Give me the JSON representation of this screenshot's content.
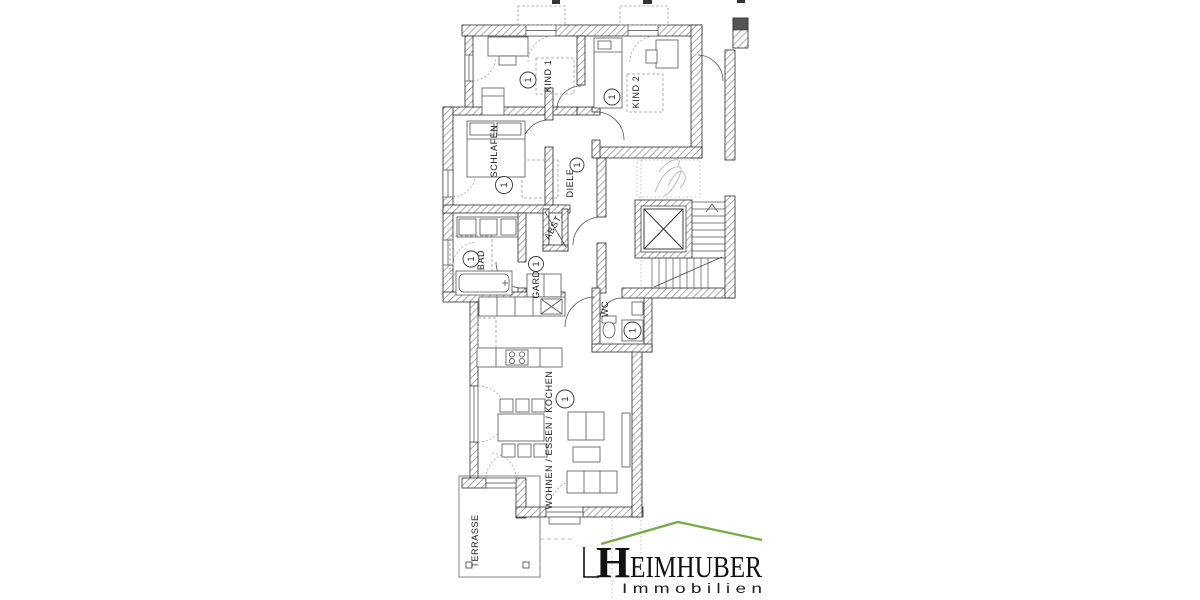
{
  "floorplan": {
    "rooms": {
      "kind1": {
        "label": "KIND 1",
        "marker": "1"
      },
      "kind2": {
        "label": "KIND 2",
        "marker": "1"
      },
      "schlafen": {
        "label": "SCHLAFEN",
        "marker": "1"
      },
      "diele": {
        "label": "DIELE",
        "marker": "1"
      },
      "abst": {
        "label": "ABST.",
        "marker": ""
      },
      "bad": {
        "label": "BAD",
        "marker": "1"
      },
      "gard": {
        "label": "GARD.",
        "marker": "1"
      },
      "wc": {
        "label": "WC",
        "marker": "1"
      },
      "wohnen": {
        "label": "WOHNEN / ESSEN / KOCHEN",
        "marker": "1"
      },
      "terrasse": {
        "label": "TERRASSE"
      }
    },
    "colors": {
      "wall_line": "#2a2a2a",
      "hatch": "#8f8f8f",
      "dashed": "#9a9a9a"
    }
  },
  "logo": {
    "brand_initial": "H",
    "brand_rest": "EIMHUBER",
    "subtitle": "I m m o b i l i e n",
    "green": "#78ac47",
    "text_color": "#111111"
  }
}
